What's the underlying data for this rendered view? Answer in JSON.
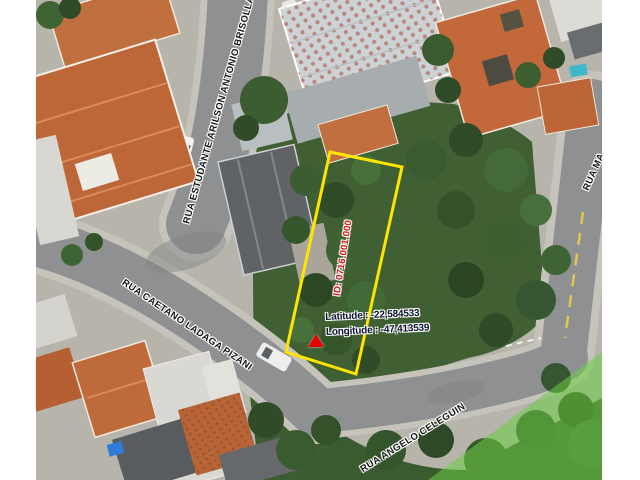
{
  "map": {
    "streets": [
      {
        "label": "RUA ESTUDANTE ARILSON ANTONIO BRISOLLA"
      },
      {
        "label": "RUA CAETANO LADAGA PIZANI"
      },
      {
        "label": "RUA ANGELO CELEGUIN"
      },
      {
        "label": "RUA MA"
      }
    ],
    "parcel": {
      "id": "ID: 0716.001.000",
      "outline_color": "#ffe400",
      "id_text_color": "#e01515"
    },
    "location": {
      "latitude": "Latitude : -22,584533",
      "longitude": "Longitude : -47,413539",
      "marker_color": "#e60000"
    },
    "highlight_zone_color": "#6ecd46"
  }
}
